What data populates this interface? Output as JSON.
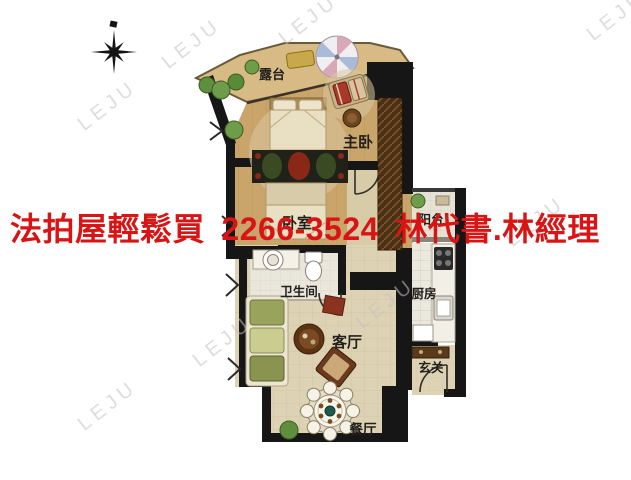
{
  "ad_banner": {
    "text": "法拍屋輕鬆買 2266-3524 林代書.林經理",
    "color": "#d91414"
  },
  "watermark": {
    "text": "LEJU"
  },
  "floor_plan": {
    "rooms": [
      {
        "id": "terrace",
        "label": "露台"
      },
      {
        "id": "master-bedroom",
        "label": "主卧"
      },
      {
        "id": "bedroom",
        "label": "卧室"
      },
      {
        "id": "balcony",
        "label": "阳台"
      },
      {
        "id": "bathroom",
        "label": "卫生间"
      },
      {
        "id": "kitchen",
        "label": "厨房"
      },
      {
        "id": "living-room",
        "label": "客厅"
      },
      {
        "id": "entrance",
        "label": "玄关"
      },
      {
        "id": "dining-room",
        "label": "餐厅"
      }
    ],
    "palette": {
      "wall": "#161616",
      "wood_floor": "#c9a46b",
      "terrace_floor": "#d7ba84",
      "tile_floor": "#ddd2b4",
      "wet_floor": "#e9e6db",
      "accent_red": "#8a2818"
    }
  }
}
